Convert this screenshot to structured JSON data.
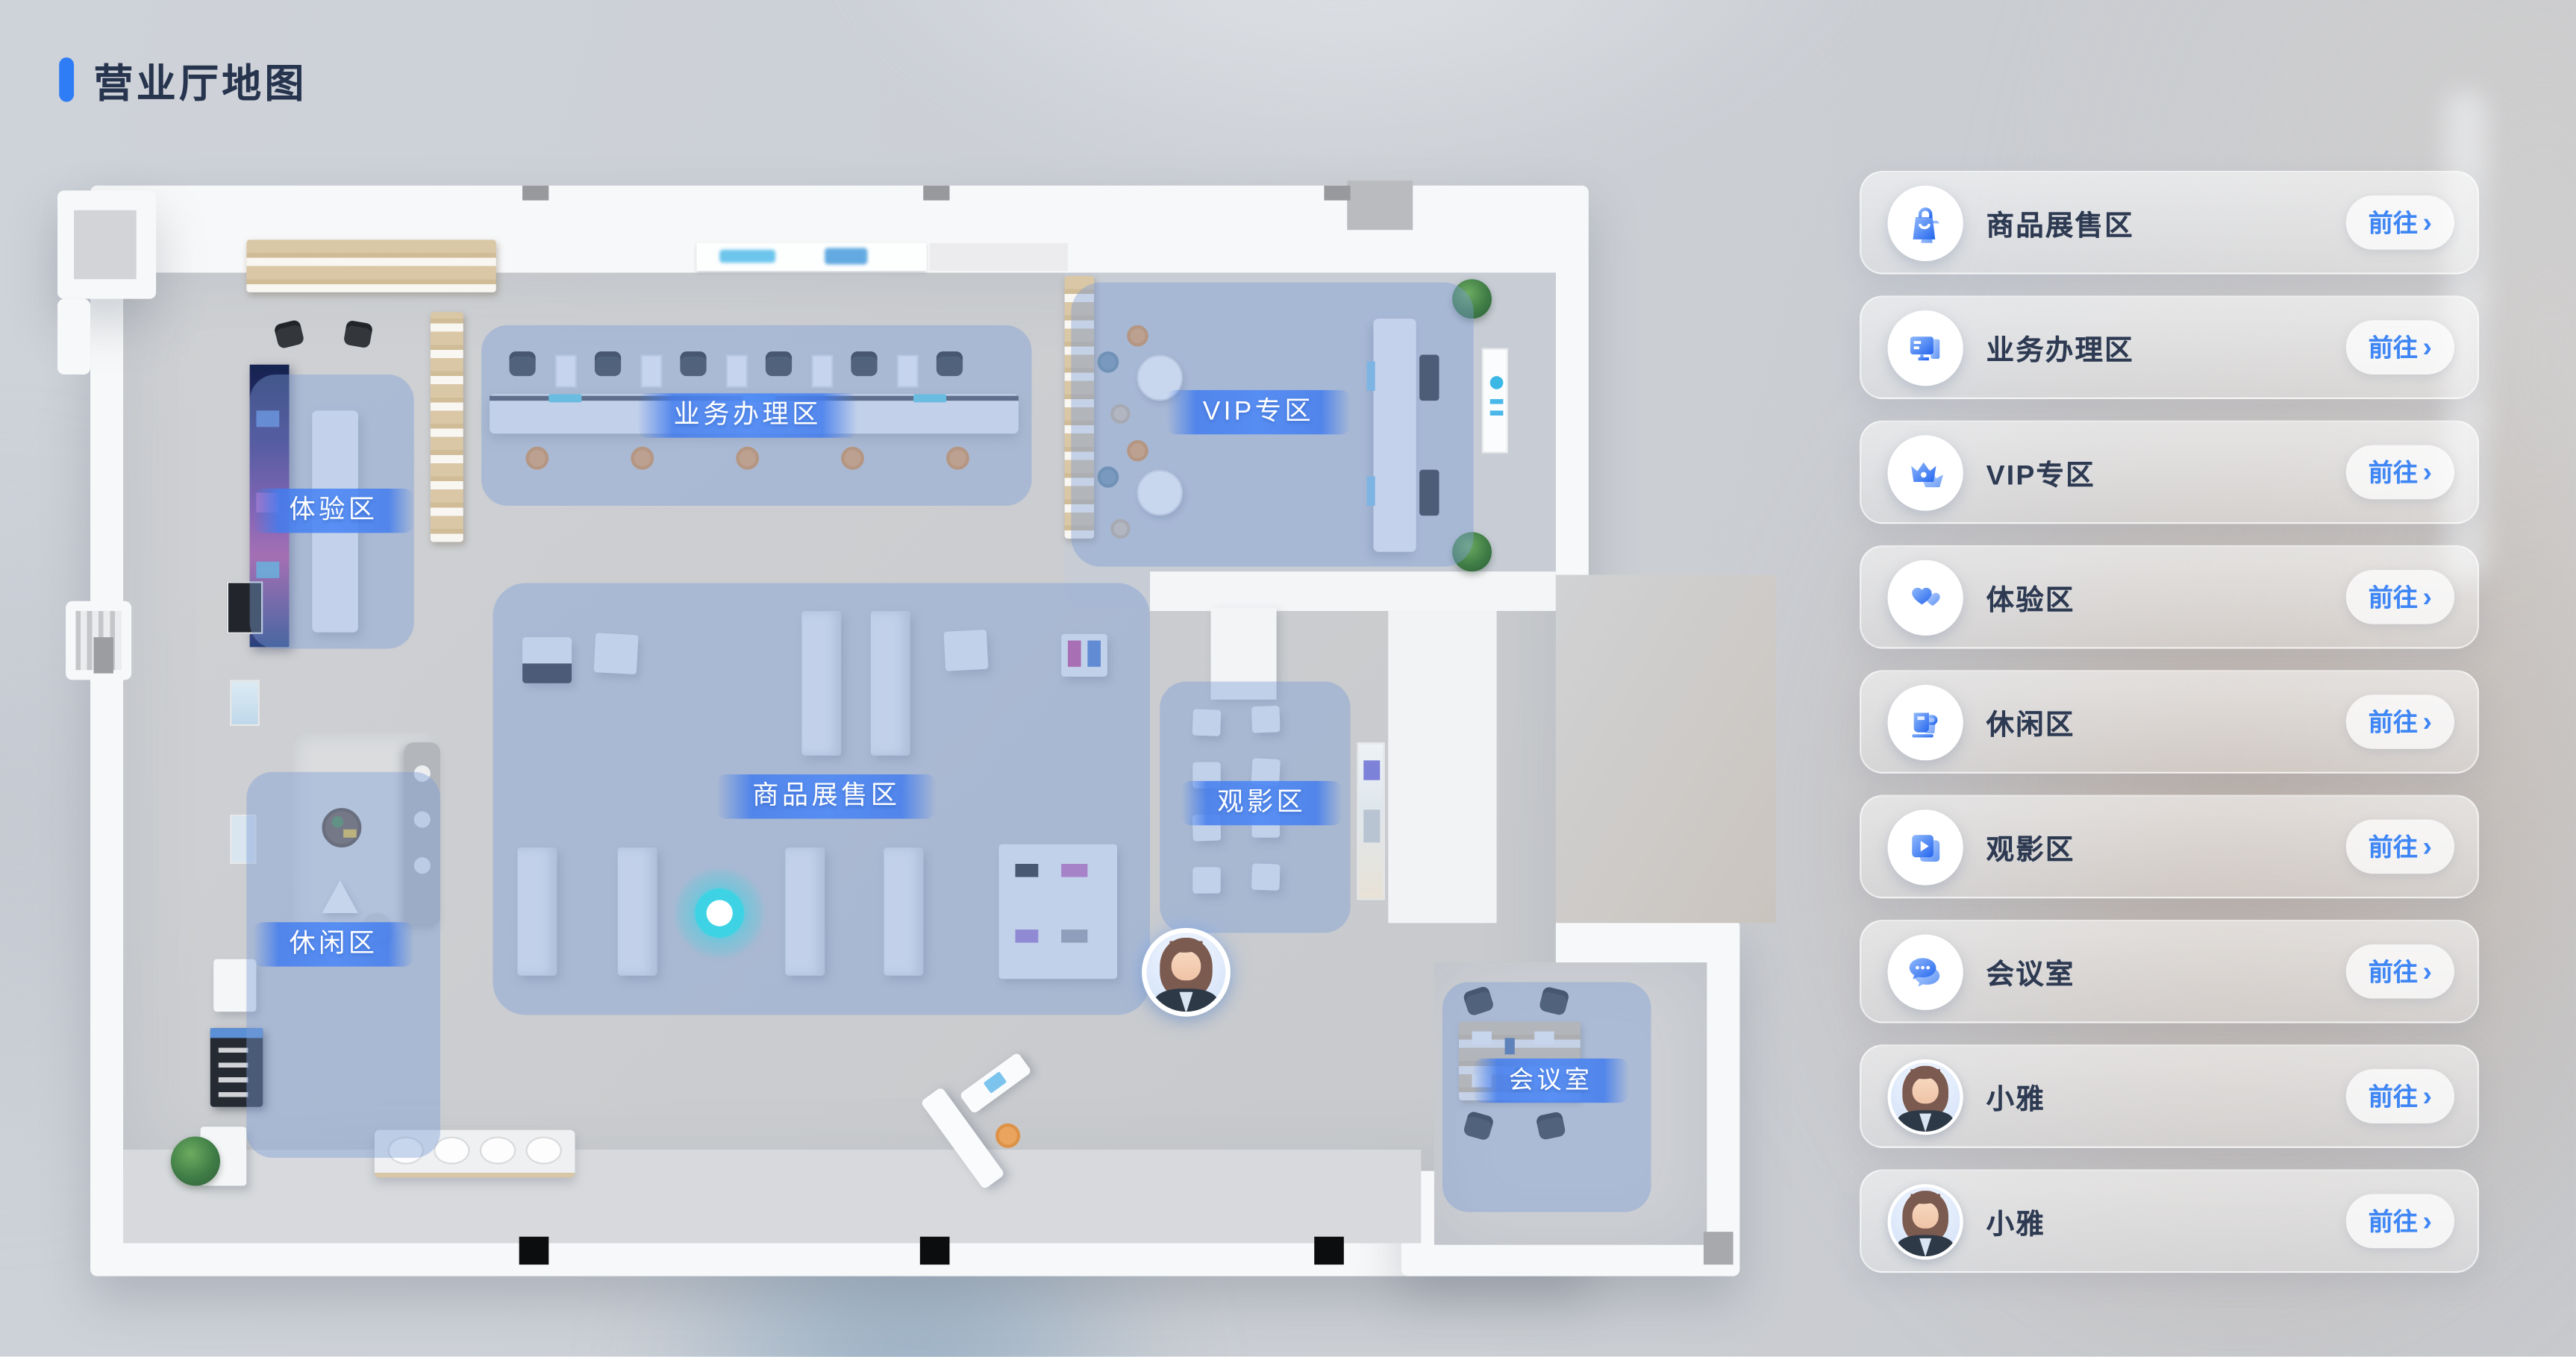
{
  "page": {
    "title": "营业厅地图"
  },
  "map": {
    "zones": [
      {
        "id": "experience",
        "label": "体验区"
      },
      {
        "id": "business",
        "label": "业务办理区"
      },
      {
        "id": "vip",
        "label": "VIP专区"
      },
      {
        "id": "products",
        "label": "商品展售区"
      },
      {
        "id": "movie",
        "label": "观影区"
      },
      {
        "id": "leisure",
        "label": "休闲区"
      },
      {
        "id": "meeting",
        "label": "会议室"
      }
    ],
    "markers": {
      "current_location_icon": "glowing-location-dot",
      "guide_avatar_icon": "xiaoya-avatar"
    }
  },
  "sidebar": {
    "items": [
      {
        "label": "商品展售区",
        "icon": "shopping-bag-icon",
        "go_label": "前往",
        "chevron": "›"
      },
      {
        "label": "业务办理区",
        "icon": "monitor-icon",
        "go_label": "前往",
        "chevron": "›"
      },
      {
        "label": "VIP专区",
        "icon": "crown-icon",
        "go_label": "前往",
        "chevron": "›"
      },
      {
        "label": "体验区",
        "icon": "hearts-icon",
        "go_label": "前往",
        "chevron": "›"
      },
      {
        "label": "休闲区",
        "icon": "coffee-cup-icon",
        "go_label": "前往",
        "chevron": "›"
      },
      {
        "label": "观影区",
        "icon": "video-play-icon",
        "go_label": "前往",
        "chevron": "›"
      },
      {
        "label": "会议室",
        "icon": "chat-bubbles-icon",
        "go_label": "前往",
        "chevron": "›"
      },
      {
        "label": "小雅",
        "icon": "xiaoya-avatar",
        "go_label": "前往",
        "chevron": "›"
      },
      {
        "label": "小雅",
        "icon": "xiaoya-avatar",
        "go_label": "前往",
        "chevron": "›"
      }
    ]
  },
  "colors": {
    "accent_blue": "#3f86f5",
    "title_text": "#27344e",
    "title_bar": "#2e7cf6",
    "zone_fill": "rgba(124,158,214,0.42)",
    "zone_label_band": "#4a86f0",
    "location_dot": "#3ed3e4"
  }
}
